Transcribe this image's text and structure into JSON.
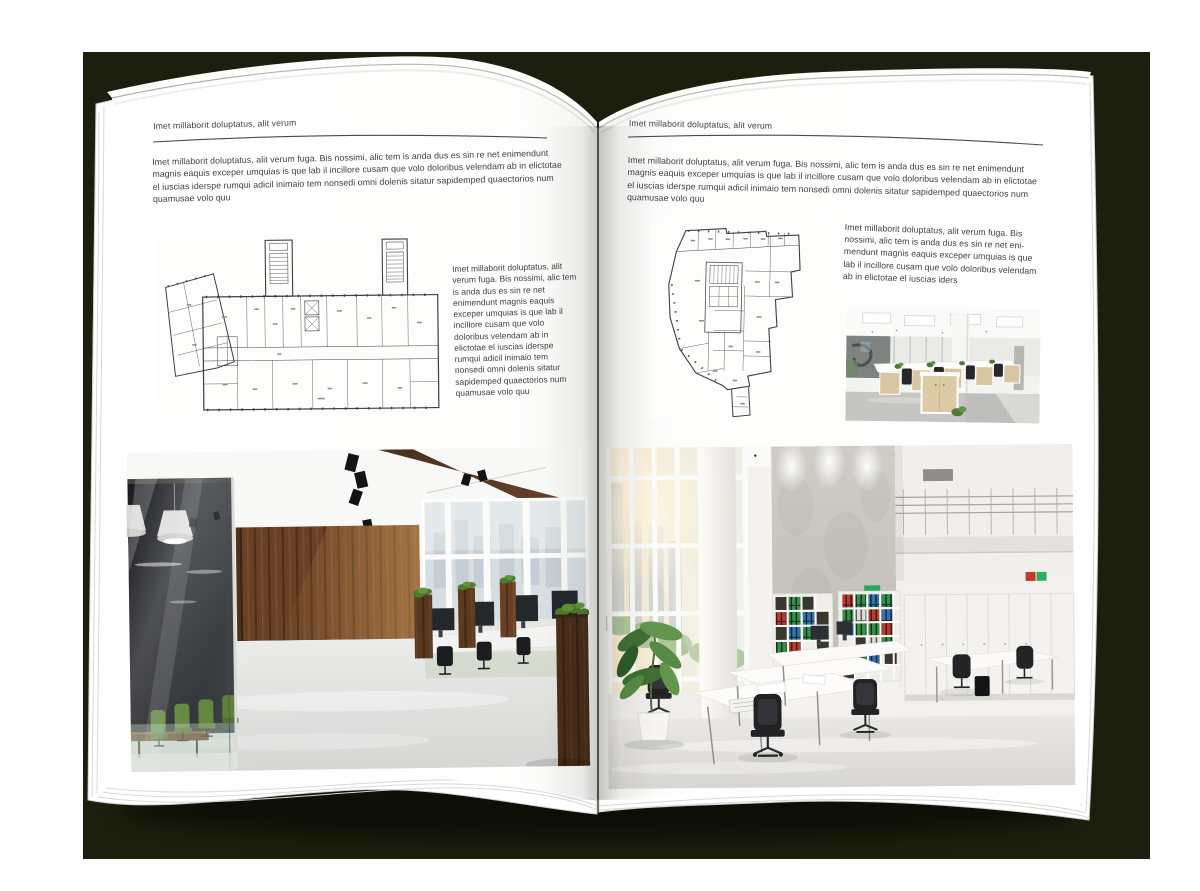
{
  "colors": {
    "backdrop": "#1c1f0d",
    "canvas": "#ffffff",
    "page": "#ffffff",
    "body_text": "#3e3e3e",
    "rule_line": "#4b4b4b",
    "plan_line": "#3f3f3f",
    "wood_brown": "#6a4124",
    "chair_green": "#5c8135",
    "binder_red": "#c03a2c",
    "binder_green": "#2e9448",
    "binder_blue": "#2e74b8",
    "plant_green": "#4e7a35"
  },
  "left_page": {
    "header": "Imet millaborit doluptatus, alit verum",
    "intro": "Imet millaborit doluptatus, alit verum fuga. Bis nossimi, alic tem is anda dus es sin re net enimendunt magnis eaquis exceper umquias is que lab il incillore cusam que volo doloribus velendam ab in elictotae el iuscias iderspe rumqui adicil inimaio tem nonsedi omni dolenis sitatur sapidemped quaectorios num quamusae volo quu",
    "side_text": "Imet millaborit doluptatus, alit verum fuga. Bis nossimi, alic tem is anda dus es sin re net enimendunt magnis eaquis exceper umquias is que lab il incillore cusam que volo doloribus velendam ab in elictotae el iuscias iderspe rumqui adicil inimaio tem nonsedi omni dolenis sitatur sapidemped quaectorios num quamusae volo quu"
  },
  "right_page": {
    "header": "Imet millaborit doluptatus, alit verum",
    "intro": "Imet millaborit doluptatus, alit verum fuga. Bis nossimi, alic tem is anda dus es sin re net enimendunt magnis eaquis exceper umquias is que lab il incillore cusam que volo doloribus velendam ab in elictotae el iuscias iderspe rumqui adicil inimaio tem nonsedi omni dolenis sitatur sapidemped quaectorios num quamusae volo quu",
    "side_text": "Imet millaborit doluptatus, alit verum fuga. Bis nossimi, alic tem is anda dus es sin re net eni-mendunt magnis eaquis exceper umquias is que lab il incillore cusam que volo doloribus velendam ab in elictotae el iuscias iders"
  },
  "images": {
    "left_floorplan": "architectural-floor-plan-wide-building",
    "right_floorplan": "architectural-floor-plan-irregular-building",
    "left_photo": "office-interior-dark-wood-glass-meeting-room",
    "right_photo_small": "open-plan-office-workstations",
    "right_photo_large": "bright-atrium-office-bookshelves"
  }
}
